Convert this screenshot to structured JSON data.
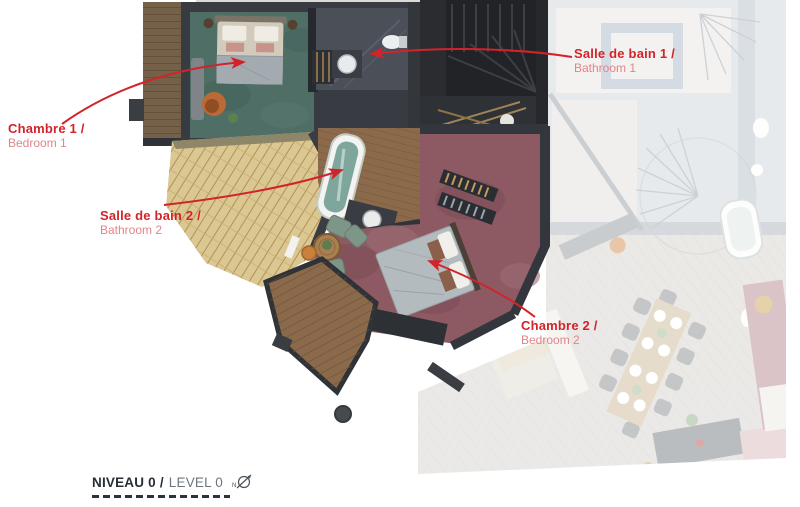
{
  "page": {
    "width_px": 800,
    "height_px": 507,
    "background": "#ffffff",
    "type": "annotated floor plan"
  },
  "annotations": {
    "bedroom1": {
      "title": "Chambre 1 /",
      "subtitle": "Bedroom 1"
    },
    "bathroom1": {
      "title": "Salle de bain 1 /",
      "subtitle": "Bathroom 1"
    },
    "bathroom2": {
      "title": "Salle de bain 2 /",
      "subtitle": "Bathroom 2"
    },
    "bedroom2": {
      "title": "Chambre 2 /",
      "subtitle": "Bedroom 2"
    }
  },
  "footer": {
    "level_label_fr": "NIVEAU 0 /",
    "level_label_en": "LEVEL 0",
    "compass_icon": "north-compass-icon",
    "compass_letter": "N"
  },
  "colors": {
    "annotation_red": "#d2232a",
    "annotation_red_light": "#e0858a",
    "footer_dark": "#262f38",
    "footer_gray": "#6d7680",
    "teal_carpet": "#4f6f66",
    "burgundy_carpet": "#8d5a63",
    "wood_floor": "#8a6a4b",
    "roof_shingles": "#dbc791",
    "dark_walls": "#34373d",
    "faded_floor": "#d6d2cc"
  }
}
